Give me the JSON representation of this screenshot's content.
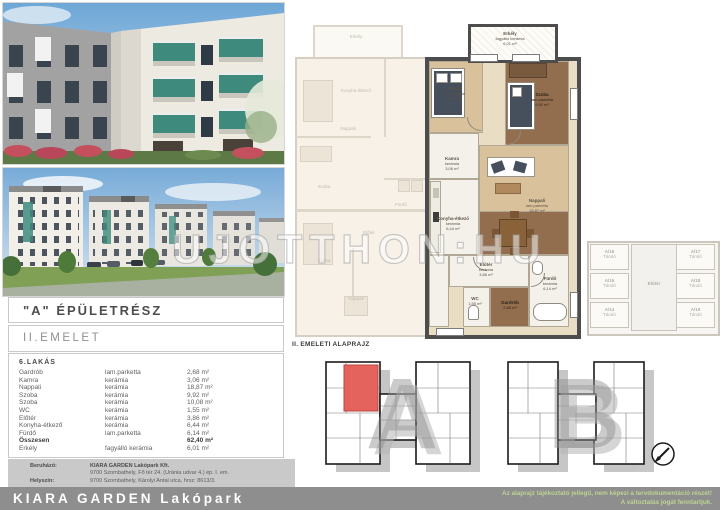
{
  "header": {
    "building_label": "\"A\" ÉPÜLETRÉSZ",
    "floor_label": "II.EMELET"
  },
  "apartment_table": {
    "title": "6.LAKÁS",
    "rows": [
      {
        "room": "Gardrób",
        "material": "lam.parketta",
        "area": "2,68 m²",
        "bold": false
      },
      {
        "room": "Kamra",
        "material": "kerámia",
        "area": "3,06 m²",
        "bold": false
      },
      {
        "room": "Nappali",
        "material": "kerámia",
        "area": "18,87 m²",
        "bold": false
      },
      {
        "room": "Szoba",
        "material": "kerámia",
        "area": "9,92 m²",
        "bold": false
      },
      {
        "room": "Szoba",
        "material": "kerámia",
        "area": "10,08 m²",
        "bold": false
      },
      {
        "room": "WC",
        "material": "kerámia",
        "area": "1,55 m²",
        "bold": false
      },
      {
        "room": "Előtér",
        "material": "kerámia",
        "area": "3,86 m²",
        "bold": false
      },
      {
        "room": "Konyha-étkező",
        "material": "kerámia",
        "area": "6,44 m²",
        "bold": false
      },
      {
        "room": "Fürdő",
        "material": "lam.parketta",
        "area": "6,14 m²",
        "bold": false
      },
      {
        "room": "Összesen",
        "material": "",
        "area": "62,40 m²",
        "bold": true
      },
      {
        "room": "Erkély",
        "material": "fagyálló kerámia",
        "area": "6,01 m²",
        "bold": false
      }
    ]
  },
  "developer": {
    "investor_label": "Beruházó:",
    "investor_name": "KIARA GARDEN Lakópark Kft.",
    "investor_address": "9700 Szombathely, Fő tér 24. (Uránia udvar 4.) ép. I. em.",
    "location_label": "Helyszín:",
    "location_address": "9700 Szombathely, Károlyi Antal utca, hrsz: 8613/3."
  },
  "footer": {
    "brand": "KIARA GARDEN Lakópark",
    "disclaimer_line1": "Az alaprajz tájékoztató jellegű, nem képezi a tervdokumentáció részét!",
    "disclaimer_line2": "A változtatás jogát fenntartjuk.",
    "bar_color": "#8e8e8e",
    "disclaimer_color": "#bdd492"
  },
  "floorplan": {
    "watermark": "UJOTTHON:HU",
    "overview_label": "II. EMELETI ALAPRAJZ",
    "highlight_color": "#e4635c",
    "rooms": [
      {
        "name": "Erkély",
        "material": "fagyálló kerámia",
        "area": "6,01 m²"
      },
      {
        "name": "Szoba",
        "material": "lam.parketta",
        "area": "10,08 m²"
      },
      {
        "name": "Szoba",
        "material": "lam.parketta",
        "area": "9,92 m²"
      },
      {
        "name": "Kamra",
        "material": "kerámia",
        "area": "3,06 m²"
      },
      {
        "name": "Nappali",
        "material": "lam.parketta",
        "area": "18,87 m²"
      },
      {
        "name": "Konyha-étkező",
        "material": "kerámia",
        "area": "6,44 m²"
      },
      {
        "name": "Előtér",
        "material": "kerámia",
        "area": "3,86 m²"
      },
      {
        "name": "WC",
        "material": "kerámia",
        "area": "1,55 m²"
      },
      {
        "name": "Gardrób",
        "material": "lam.parketta",
        "area": "2,68 m²"
      },
      {
        "name": "Fürdő",
        "material": "kerámia",
        "area": "6,14 m²"
      }
    ],
    "neighbor_labels": [
      "Erkély",
      "Konyha-étkező",
      "Nappali",
      "Szoba",
      "Fürdő",
      "Előtér",
      "Szoba",
      "Nappali"
    ],
    "storage": {
      "corridor": "Előtér",
      "units": [
        {
          "id": "A/16",
          "type": "Tároló"
        },
        {
          "id": "A/15",
          "type": "Tároló"
        },
        {
          "id": "A/14",
          "type": "Tároló"
        },
        {
          "id": "A/17",
          "type": "Tároló"
        },
        {
          "id": "A/18",
          "type": "Tároló"
        },
        {
          "id": "A/19",
          "type": "Tároló"
        }
      ]
    },
    "overview": {
      "letter_a": "A",
      "letter_b": "B"
    }
  }
}
